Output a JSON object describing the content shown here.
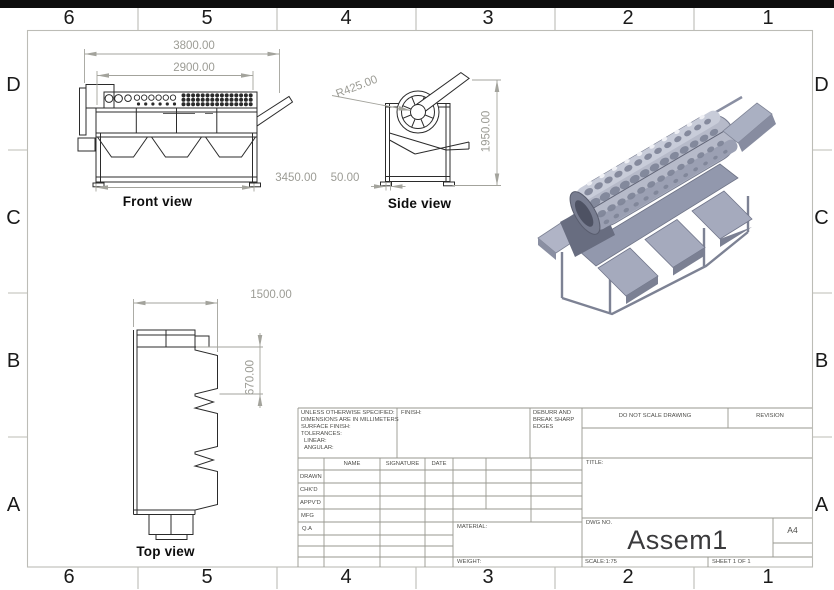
{
  "zones": {
    "columns": [
      "6",
      "5",
      "4",
      "3",
      "2",
      "1"
    ],
    "rows": [
      "D",
      "C",
      "B",
      "A"
    ]
  },
  "views": {
    "front": {
      "label": "Front view",
      "dim_overall": "3800.00",
      "dim_drum": "2900.00",
      "dim_base": "3450.00"
    },
    "side": {
      "label": "Side view",
      "dim_radius": "R425.00",
      "dim_height": "1950.00",
      "dim_offset": "50.00"
    },
    "top": {
      "label": "Top view",
      "dim_length": "1500.00",
      "dim_chute": "670.00"
    }
  },
  "title_block": {
    "spec_lines": [
      "UNLESS OTHERWISE SPECIFIED:",
      "DIMENSIONS ARE IN MILLIMETERS",
      "SURFACE FINISH:",
      "TOLERANCES:",
      "LINEAR:",
      "ANGULAR:"
    ],
    "finish_label": "FINISH:",
    "deburr_lines": [
      "DEBURR AND",
      "BREAK SHARP",
      "EDGES"
    ],
    "do_not_scale": "DO NOT SCALE DRAWING",
    "revision_label": "REVISION",
    "col_name": "NAME",
    "col_signature": "SIGNATURE",
    "col_date": "DATE",
    "row_labels": [
      "DRAWN",
      "CHK'D",
      "APPV'D",
      "MFG",
      "Q.A"
    ],
    "material_label": "MATERIAL:",
    "weight_label": "WEIGHT:",
    "title_label": "TITLE:",
    "dwg_label": "DWG NO.",
    "dwg_value": "Assem1",
    "paper_size": "A4",
    "scale_text": "SCALE:1:75",
    "sheet_text": "SHEET 1 OF 1"
  },
  "colors": {
    "line": "#2b2b2b",
    "dimension": "#9c9c95",
    "border": "#bcbcb6",
    "model_gray": "#9aa0b6"
  }
}
